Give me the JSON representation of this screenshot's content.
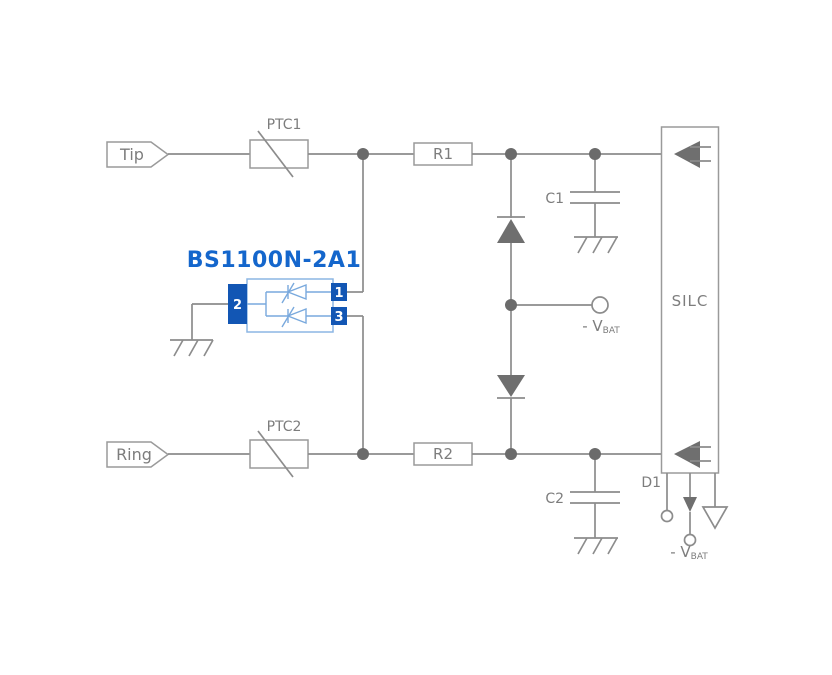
{
  "diagram_title": "Telephone line protection application circuit",
  "colors": {
    "wire": "#8c8c8c",
    "dot": "#6b6b6b",
    "symbol_fill": "#6f6f6f",
    "label": "#7d7d7d",
    "box_stroke": "#9a9a9a",
    "blue_title": "#1466cc",
    "blue_pin": "#1256b4",
    "blue_outline": "#8cb6e4",
    "blue_symbol": "#79a9dd",
    "background": "#ffffff"
  },
  "labels": {
    "tip": "Tip",
    "ring": "Ring",
    "ptc1": "PTC1",
    "ptc2": "PTC2",
    "r1": "R1",
    "r2": "R2",
    "c1": "C1",
    "c2": "C2",
    "silc": "SILC",
    "d1": "D1",
    "vbat_prefix": "- V",
    "vbat_sub": "BAT"
  },
  "device": {
    "part_number": "BS1100N-2A1",
    "pins": [
      {
        "number": "1"
      },
      {
        "number": "2"
      },
      {
        "number": "3"
      }
    ]
  }
}
